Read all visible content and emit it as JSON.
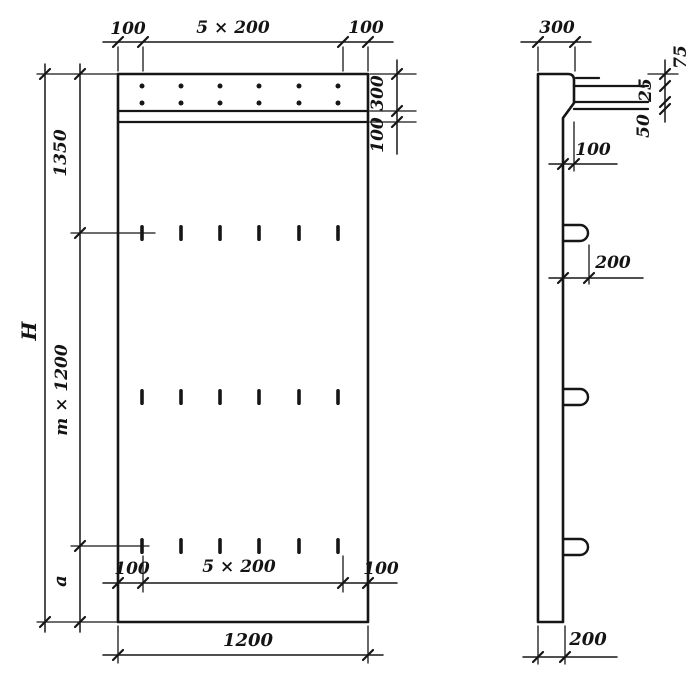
{
  "front_view": {
    "top": {
      "left": "100",
      "center": "5 × 200",
      "right": "100"
    },
    "right": {
      "band": "300",
      "strip": "100"
    },
    "left": {
      "overall": "H",
      "top": "1350",
      "middle": "m × 1200",
      "bottom": "a"
    },
    "bottom_inner": {
      "left": "100",
      "center": "5 × 200",
      "right": "100"
    },
    "bottom": {
      "overall": "1200"
    }
  },
  "side_view": {
    "top": "300",
    "chain": [
      "75",
      "25",
      "50"
    ],
    "step": "100",
    "loop": "200",
    "bottom": "200"
  }
}
